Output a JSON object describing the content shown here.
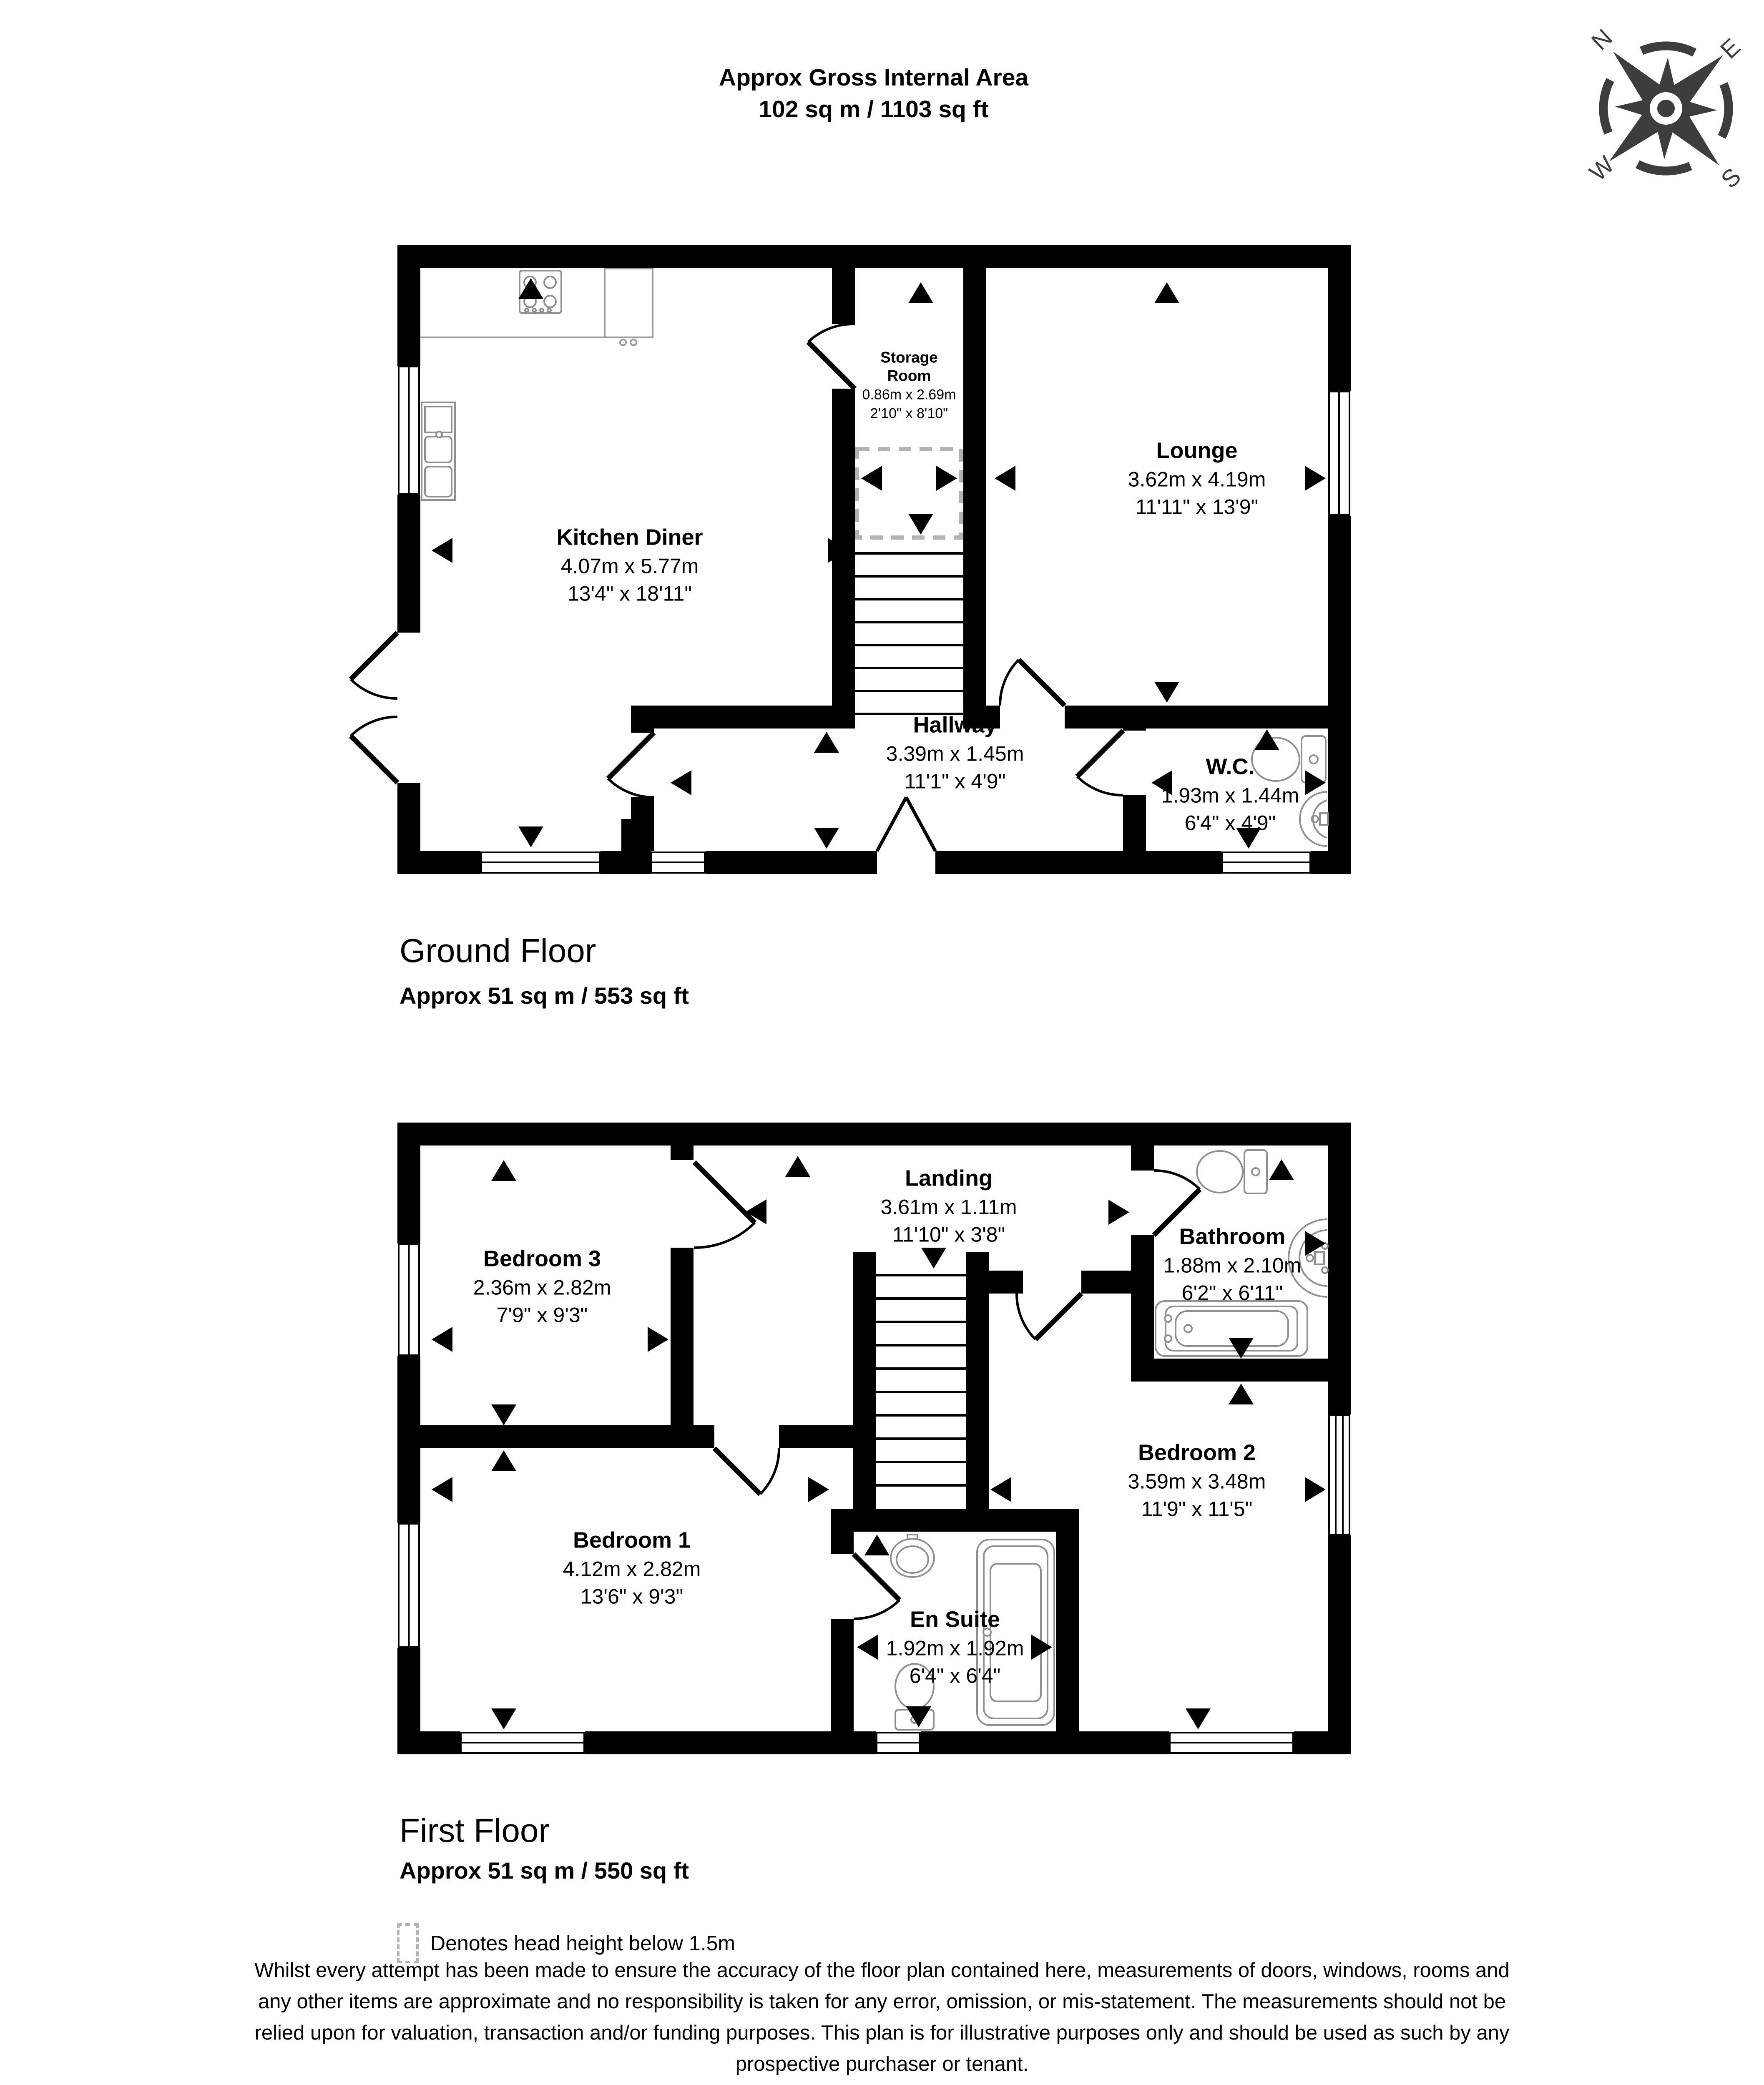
{
  "header": {
    "line1": "Approx Gross Internal Area",
    "line2": "102 sq m / 1103 sq ft"
  },
  "compass": {
    "north": "N",
    "east": "E",
    "south": "S",
    "west": "W"
  },
  "ground_floor": {
    "title": "Ground Floor",
    "area": "Approx 51 sq m / 553 sq ft",
    "rooms": {
      "kitchen": {
        "name": "Kitchen Diner",
        "metric": "4.07m x 5.77m",
        "imperial": "13'4\" x 18'11\""
      },
      "storage": {
        "name": "Storage Room",
        "metric": "0.86m x 2.69m",
        "imperial": "2'10\" x 8'10\""
      },
      "lounge": {
        "name": "Lounge",
        "metric": "3.62m x 4.19m",
        "imperial": "11'11\" x 13'9\""
      },
      "hallway": {
        "name": "Hallway",
        "metric": "3.39m x 1.45m",
        "imperial": "11'1\" x 4'9\""
      },
      "wc": {
        "name": "W.C.",
        "metric": "1.93m x 1.44m",
        "imperial": "6'4\" x 4'9\""
      }
    }
  },
  "first_floor": {
    "title": "First Floor",
    "area": "Approx 51 sq m / 550 sq ft",
    "rooms": {
      "bedroom3": {
        "name": "Bedroom 3",
        "metric": "2.36m x 2.82m",
        "imperial": "7'9\" x 9'3\""
      },
      "landing": {
        "name": "Landing",
        "metric": "3.61m x 1.11m",
        "imperial": "11'10\" x 3'8\""
      },
      "bathroom": {
        "name": "Bathroom",
        "metric": "1.88m x 2.10m",
        "imperial": "6'2\" x 6'11\""
      },
      "bedroom2": {
        "name": "Bedroom 2",
        "metric": "3.59m x 3.48m",
        "imperial": "11'9\" x 11'5\""
      },
      "bedroom1": {
        "name": "Bedroom 1",
        "metric": "4.12m x 2.82m",
        "imperial": "13'6\" x 9'3\""
      },
      "ensuite": {
        "name": "En Suite",
        "metric": "1.92m x 1.92m",
        "imperial": "6'4\" x 6'4\""
      }
    }
  },
  "legend": {
    "text": "Denotes head height below 1.5m"
  },
  "disclaimer": {
    "lines": [
      "Whilst every attempt has been made to ensure the accuracy of the floor plan contained here, measurements of doors, windows, rooms and",
      "any other items are approximate and no responsibility is taken for any error, omission, or mis-statement. The measurements should not be",
      "relied upon for valuation, transaction and/or funding purposes. This plan is for illustrative purposes only and should be used as such by any",
      "prospective purchaser or tenant."
    ]
  },
  "colors": {
    "wall": "#000000",
    "fixture": "#8f8f8f",
    "head_height_dash": "#b3b3b3",
    "compass": "#3d3d3d"
  }
}
